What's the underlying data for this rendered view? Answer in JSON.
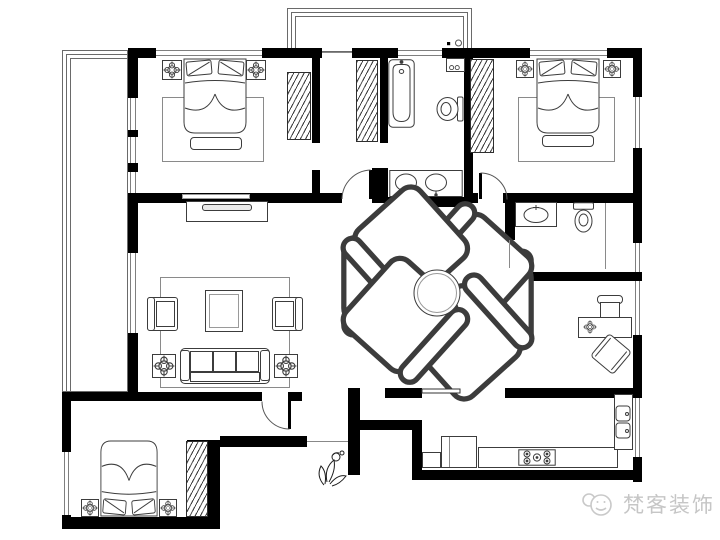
{
  "watermark": {
    "logo": "chat-faces-logo",
    "text": "梵客装饰",
    "color": "#c6c6c6"
  },
  "plan": {
    "background": "#ffffff",
    "wall_color": "#000000",
    "furniture_line_color": "#3c3c3c",
    "window_line_color": "#7f7f7f",
    "rooms": [
      {
        "name": "balcony-left",
        "items": []
      },
      {
        "name": "balcony-top",
        "items": [
          "drain-mark",
          "drain-circle"
        ]
      },
      {
        "name": "bedroom-top-left",
        "items": [
          "double-bed",
          "nightstand-left",
          "nightstand-right",
          "area-rug",
          "foot-bench",
          "wardrobe"
        ]
      },
      {
        "name": "walk-in-closet",
        "items": [
          "wardrobe"
        ]
      },
      {
        "name": "bathroom-main",
        "items": [
          "bathtub",
          "washing-machine",
          "toilet",
          "double-sink-vanity"
        ]
      },
      {
        "name": "bedroom-top-right",
        "items": [
          "double-bed",
          "nightstand-left",
          "nightstand-right",
          "area-rug",
          "foot-bench",
          "wardrobe"
        ]
      },
      {
        "name": "living-room",
        "items": [
          "tv-cabinet",
          "tv",
          "area-rug",
          "coffee-table",
          "armchair-left",
          "armchair-right",
          "three-seat-sofa",
          "side-table-left",
          "side-table-right"
        ]
      },
      {
        "name": "dining-area",
        "items": [
          "round-dining-table",
          "dining-chair",
          "dining-chair",
          "dining-chair",
          "dining-chair",
          "dining-chair",
          "dining-chair"
        ]
      },
      {
        "name": "bathroom-small",
        "items": [
          "sink-counter",
          "toilet",
          "partition-line"
        ]
      },
      {
        "name": "study",
        "items": [
          "desk",
          "desk-lamp-symbol",
          "office-chair",
          "lounge-chair"
        ]
      },
      {
        "name": "bedroom-bottom-left",
        "items": [
          "double-bed",
          "nightstand-left",
          "nightstand-right",
          "wardrobe"
        ]
      },
      {
        "name": "foyer",
        "items": [
          "entry-plant-sketch",
          "swing-door"
        ]
      },
      {
        "name": "kitchen",
        "items": [
          "base-cabinet",
          "fridge",
          "counter",
          "gas-stove",
          "double-sink",
          "sliding-door"
        ]
      }
    ],
    "doors": [
      "swing-door-closet",
      "swing-door-bedroom-right",
      "swing-door-foyer",
      "sliding-door-kitchen",
      "entry-opening"
    ]
  }
}
